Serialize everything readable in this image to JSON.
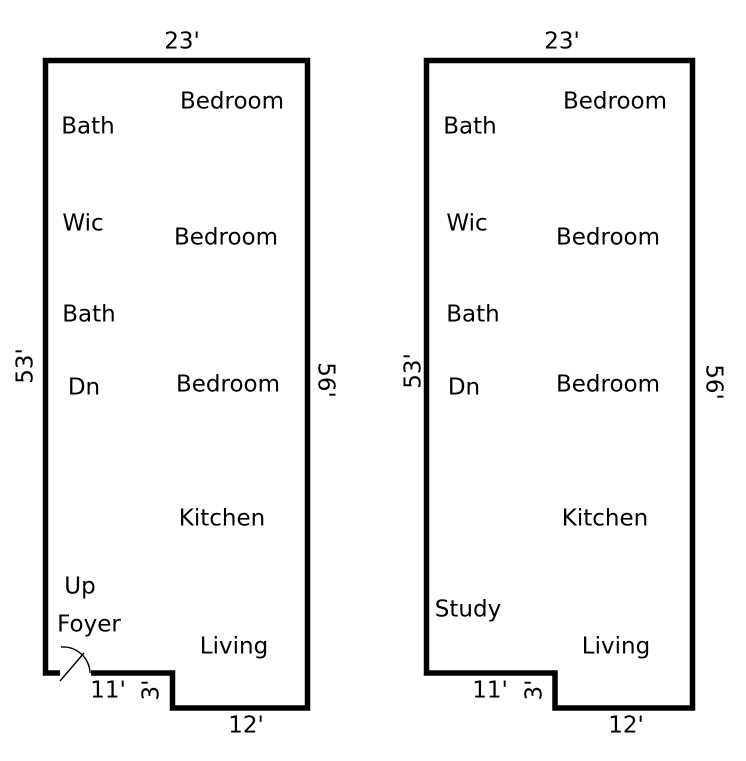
{
  "canvas": {
    "background": "#ffffff",
    "wall_color": "#000000",
    "text_color": "#000000"
  },
  "plan_left": {
    "dim_top": "23'",
    "dim_left": "53'",
    "dim_right": "56'",
    "dim_bottom_left": "11'",
    "dim_notch": "3'",
    "dim_bottom_right": "12'",
    "bedroom_top": "Bedroom",
    "bath_top": "Bath",
    "wic": "Wic",
    "bedroom_middle": "Bedroom",
    "bath_middle": "Bath",
    "stairs_down": "Dn",
    "bedroom_lower": "Bedroom",
    "kitchen": "Kitchen",
    "stairs_up": "Up",
    "foyer": "Foyer",
    "living": "Living"
  },
  "plan_right": {
    "dim_top": "23'",
    "dim_left": "53'",
    "dim_right": "56'",
    "dim_bottom_left": "11'",
    "dim_notch": "3'",
    "dim_bottom_right": "12'",
    "bedroom_top": "Bedroom",
    "bath_top": "Bath",
    "wic": "Wic",
    "bedroom_middle": "Bedroom",
    "bath_middle": "Bath",
    "stairs_down": "Dn",
    "bedroom_lower": "Bedroom",
    "kitchen": "Kitchen",
    "study": "Study",
    "living": "Living"
  }
}
